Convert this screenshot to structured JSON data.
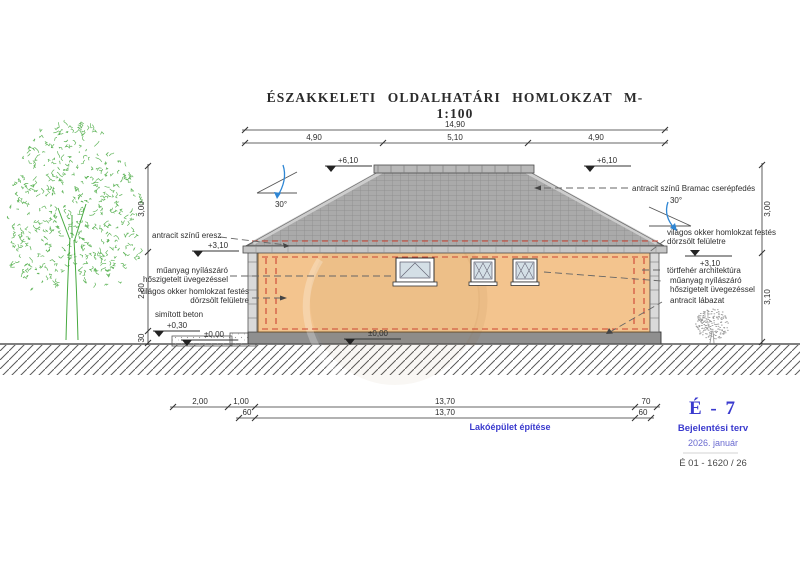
{
  "title": "ÉSZAKKELETI OLDALHATÁRI HOMLOKZAT M-1:100",
  "dims": {
    "top_total": "14,90",
    "top_seg1": "4,90",
    "top_seg2": "5,10",
    "top_seg3": "4,90",
    "left_v1": "3,00",
    "left_v2": "2,80",
    "left_v3": "30",
    "right_v1": "3,00",
    "right_v2": "3,10",
    "b1_1": "2,00",
    "b1_2": "1,00",
    "b1_3": "13,70",
    "b1_4": "70",
    "b2_1": "60",
    "b2_2": "13,70",
    "b2_3": "60"
  },
  "levels": {
    "eave_left": "+6,10",
    "eave_right": "+6,10",
    "walltop_left": "+3,10",
    "walltop_right": "+3,10",
    "sidewalk": "+0,30",
    "floor_left": "±0,00",
    "floor_center": "±0,00"
  },
  "slope": {
    "left": "30°",
    "right": "30°"
  },
  "notes_left": {
    "eaves": "antracit színű eresz",
    "window1": "műanyag nyílászáró",
    "window2": "hőszigetelt üvegezéssel",
    "facade1": "világos okker homlokzat festés",
    "facade2": "dörzsölt felületre",
    "concrete": "simított beton"
  },
  "notes_right": {
    "roof": "antracit színű Bramac cserépfedés",
    "facade1": "világos okker homlokzat festés",
    "facade2": "dörzsölt felületre",
    "trim": "törtfehér architektúra",
    "window1": "műanyag nyílászáró",
    "window2": "hőszigetelt üvegezéssel",
    "plinth": "antracit lábazat"
  },
  "titleblock": {
    "project": "Lakóépület építése",
    "sheet_code": "É - 7",
    "phase": "Bejelentési terv",
    "date": "2026. január",
    "doc_number": "É 01 - 1620 / 26"
  },
  "colors": {
    "wall": "#f3c48e",
    "roof": "#aaaaaa",
    "roof_line": "#8c8c8c",
    "fascia": "#c6c6c6",
    "plinth": "#8f8f8f",
    "glass": "#d4dfe6",
    "insulation_dash": "#cc4433",
    "blueprint_blue": "#3a3ace",
    "tree_green": "#46a93f",
    "slope_arrow_blue": "#2e86d4"
  }
}
